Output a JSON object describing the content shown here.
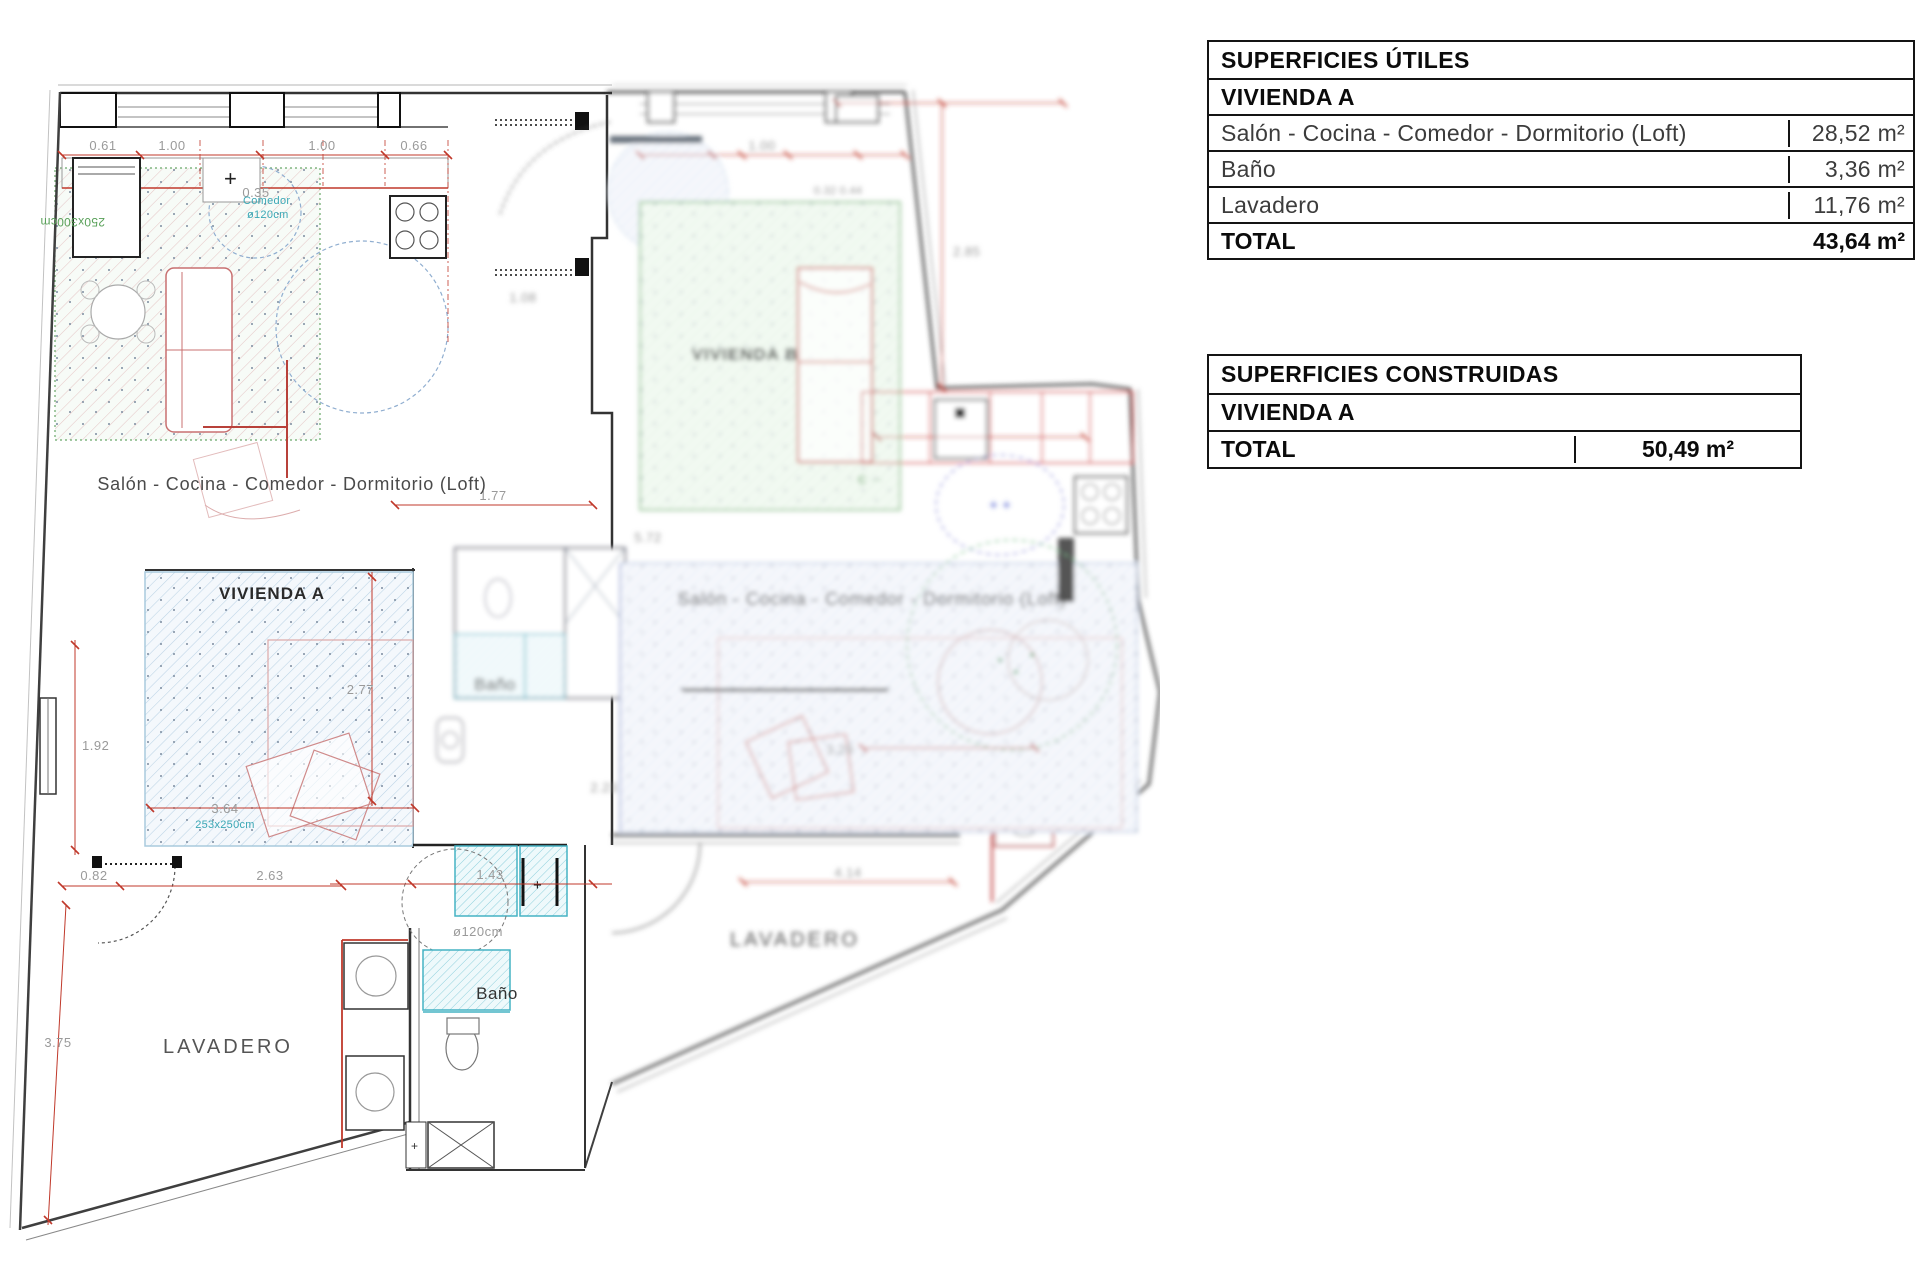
{
  "tables": {
    "utiles": {
      "title": "SUPERFICIES ÚTILES",
      "subtitle": "VIVIENDA A",
      "rows": [
        {
          "label": "Salón - Cocina - Comedor - Dormitorio (Loft)",
          "value": "28,52  m²"
        },
        {
          "label": "Baño",
          "value": "3,36  m²"
        },
        {
          "label": "Lavadero",
          "value": "11,76  m²"
        }
      ],
      "total_label": "TOTAL",
      "total_value": "43,64  m²"
    },
    "construidas": {
      "title": "SUPERFICIES CONSTRUIDAS",
      "subtitle": "VIVIENDA A",
      "total_label": "TOTAL",
      "total_value": "50,49  m²"
    }
  },
  "plan": {
    "labels": {
      "salon_a": "Salón - Cocina - Comedor - Dormitorio (Loft)",
      "vivienda_a": "VIVIENDA A",
      "vivienda_b": "VIVIENDA B",
      "salon_b": "Salón - Cocina - Comedor - Dormitorio (Loft)",
      "bano_lower": "Baño",
      "bano_mid": "Baño",
      "lavadero_left": "LAVADERO",
      "lavadero_right": "LAVADERO",
      "comedor_circle_1": "Comedor",
      "comedor_circle_2": "ø120cm",
      "shower_circle": "ø120cm",
      "bed_size_green": "250x300cm",
      "bed_size_blue": "253x250cm",
      "green_mark": "Є ⋯"
    },
    "dims": {
      "d061": "0.61",
      "d100a": "1.00",
      "d100b": "1.00",
      "d066": "0.66",
      "d035": "0.35",
      "d100c": "1.00",
      "d032": "0.32 0.44",
      "d285": "2.85",
      "d108": "1.08",
      "d177": "1.77",
      "d277": "2.77",
      "d192": "1.92",
      "d364": "3.64",
      "d082": "0.82",
      "d263": "2.63",
      "d375": "3.75",
      "d143": "1.43",
      "d572": "5.72",
      "d223": "2.23",
      "d329": "3.29",
      "d414": "4.14"
    },
    "colors": {
      "wall": "#3f3f3f",
      "dimension_red": "#c0392b",
      "dim_text_gray": "#9a9a9a",
      "hatch_blue": "#bcd4e6",
      "hatch_green_border": "#6aa86a",
      "bath_cyan": "#45b3c4",
      "furniture_red": "#c87070",
      "teal_text": "#3aa7b5",
      "circle_blue": "#90aed0",
      "circle_purple": "#8f8fd8",
      "circle_green": "#7fbf8f"
    }
  }
}
